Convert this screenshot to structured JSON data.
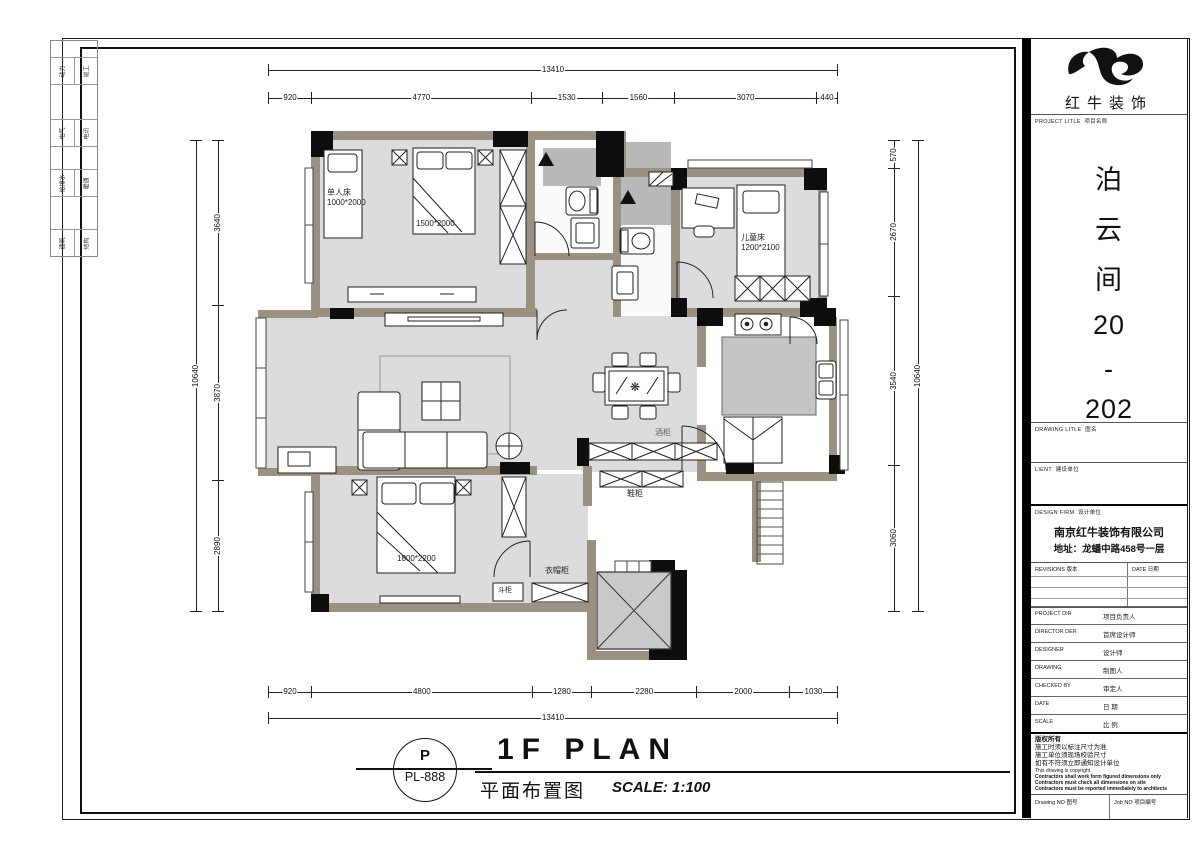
{
  "brand": {
    "logo_name": "redbull-swoosh",
    "company_logo_text": "红牛装饰"
  },
  "title_block": {
    "project_label_en": "PROJECT LITLE",
    "project_label_zh": "项目名称",
    "project_name_chars": [
      "泊",
      "云",
      "间",
      "20",
      "-",
      "202"
    ],
    "drawing_title_label_en": "DRAWING LITLE",
    "drawing_title_label_zh": "图名",
    "client_label_en": "LIENT",
    "client_label_zh": "建设单位",
    "design_firm_label_en": "DESIGN FIRM",
    "design_firm_label_zh": "设计单位",
    "design_firm_name": "南京红牛装饰有限公司",
    "design_firm_address": "地址：龙蟠中路458号一层",
    "revisions_label_en": "REVISIONS",
    "revisions_label_zh": "版本",
    "date_col_label_en": "DATE",
    "date_col_label_zh": "日期",
    "rows": [
      {
        "en": "PROJECT DIR",
        "zh": "项目负责人"
      },
      {
        "en": "DIRECTOR DER",
        "zh": "首席设计师"
      },
      {
        "en": "DESIGNER",
        "zh": "设计师"
      },
      {
        "en": "DRAWING",
        "zh": "制图人"
      },
      {
        "en": "CHECKED BY",
        "zh": "审定人"
      },
      {
        "en": "DATE",
        "zh": "日  期"
      },
      {
        "en": "SCALE",
        "zh": "比  例"
      }
    ],
    "copyright_zh": [
      "版权所有",
      "施工时须以标注尺寸为准",
      "施工单位须现场校验尺寸",
      "如有不符须立即通知设计单位"
    ],
    "copyright_en": [
      "This drawing is copyright",
      "Contractors shall work form figured dimensions only",
      "Contractors must check all dimensions on site",
      "Contractors must be reported immediately to architects"
    ],
    "drawing_no_label_en": "Drawing NO",
    "drawing_no_label_zh": "图号",
    "job_no_label_en": "Job NO",
    "job_no_label_zh": "项目编号"
  },
  "sheet_title": {
    "code_top": "P",
    "code_bottom": "PL-888",
    "title_en": "1F PLAN",
    "title_zh": "平面布置图",
    "scale_text": "SCALE: 1:100"
  },
  "left_strip": {
    "rows": [
      {
        "a": "动力",
        "b": "竣工"
      },
      {
        "a": "电气",
        "b": "电讯"
      },
      {
        "a": "给排水",
        "b": "暖通"
      },
      {
        "a": "建筑",
        "b": "结构"
      }
    ]
  },
  "plan_labels": {
    "single_bed_name": "单人床",
    "single_bed_size": "1000*2000",
    "double_bed_size": "1500*2000",
    "kids_bed_name": "儿童床",
    "kids_bed_size": "1200*2100",
    "master_bed_size": "1800*2200",
    "wine_cabinet": "酒柜",
    "shoe_cabinet": "鞋柜",
    "cloak_cabinet": "衣帽柜",
    "chest_cabinet": "斗柜"
  },
  "icons": {
    "chandelier": "❋",
    "lamp": "✦"
  },
  "dimensions": {
    "top_total": [
      {
        "label": "13410",
        "v": 13410
      }
    ],
    "top_chain": [
      {
        "label": "920",
        "v": 920
      },
      {
        "label": "4770",
        "v": 4770
      },
      {
        "label": "1530",
        "v": 1530
      },
      {
        "label": "1560",
        "v": 1560
      },
      {
        "label": "3070",
        "v": 3070
      },
      {
        "label": "440",
        "v": 440
      }
    ],
    "bottom_chain": [
      {
        "label": "920",
        "v": 920
      },
      {
        "label": "4800",
        "v": 4800
      },
      {
        "label": "1280",
        "v": 1280
      },
      {
        "label": "2280",
        "v": 2280
      },
      {
        "label": "2000",
        "v": 2000
      },
      {
        "label": "1030",
        "v": 1030
      }
    ],
    "bottom_total": [
      {
        "label": "13410",
        "v": 13410
      }
    ],
    "left_total": [
      {
        "label": "10640",
        "v": 10640
      }
    ],
    "left_chain": [
      {
        "label": "3640",
        "v": 3640
      },
      {
        "label": "3870",
        "v": 3870
      },
      {
        "label": "2890",
        "v": 2890
      }
    ],
    "right_chain": [
      {
        "label": "570",
        "v": 570
      },
      {
        "label": "2670",
        "v": 2670
      },
      {
        "label": "3540",
        "v": 3540
      },
      {
        "label": "3060",
        "v": 3060
      }
    ],
    "right_total": [
      {
        "label": "10640",
        "v": 10640
      }
    ]
  },
  "colors": {
    "wall": "#9a9183",
    "floor": "#dcdcde",
    "column": "#0d0d0d",
    "shower": "#b9b9ba",
    "island": "#c4c4c6",
    "elevator": "#c9c9cb"
  }
}
